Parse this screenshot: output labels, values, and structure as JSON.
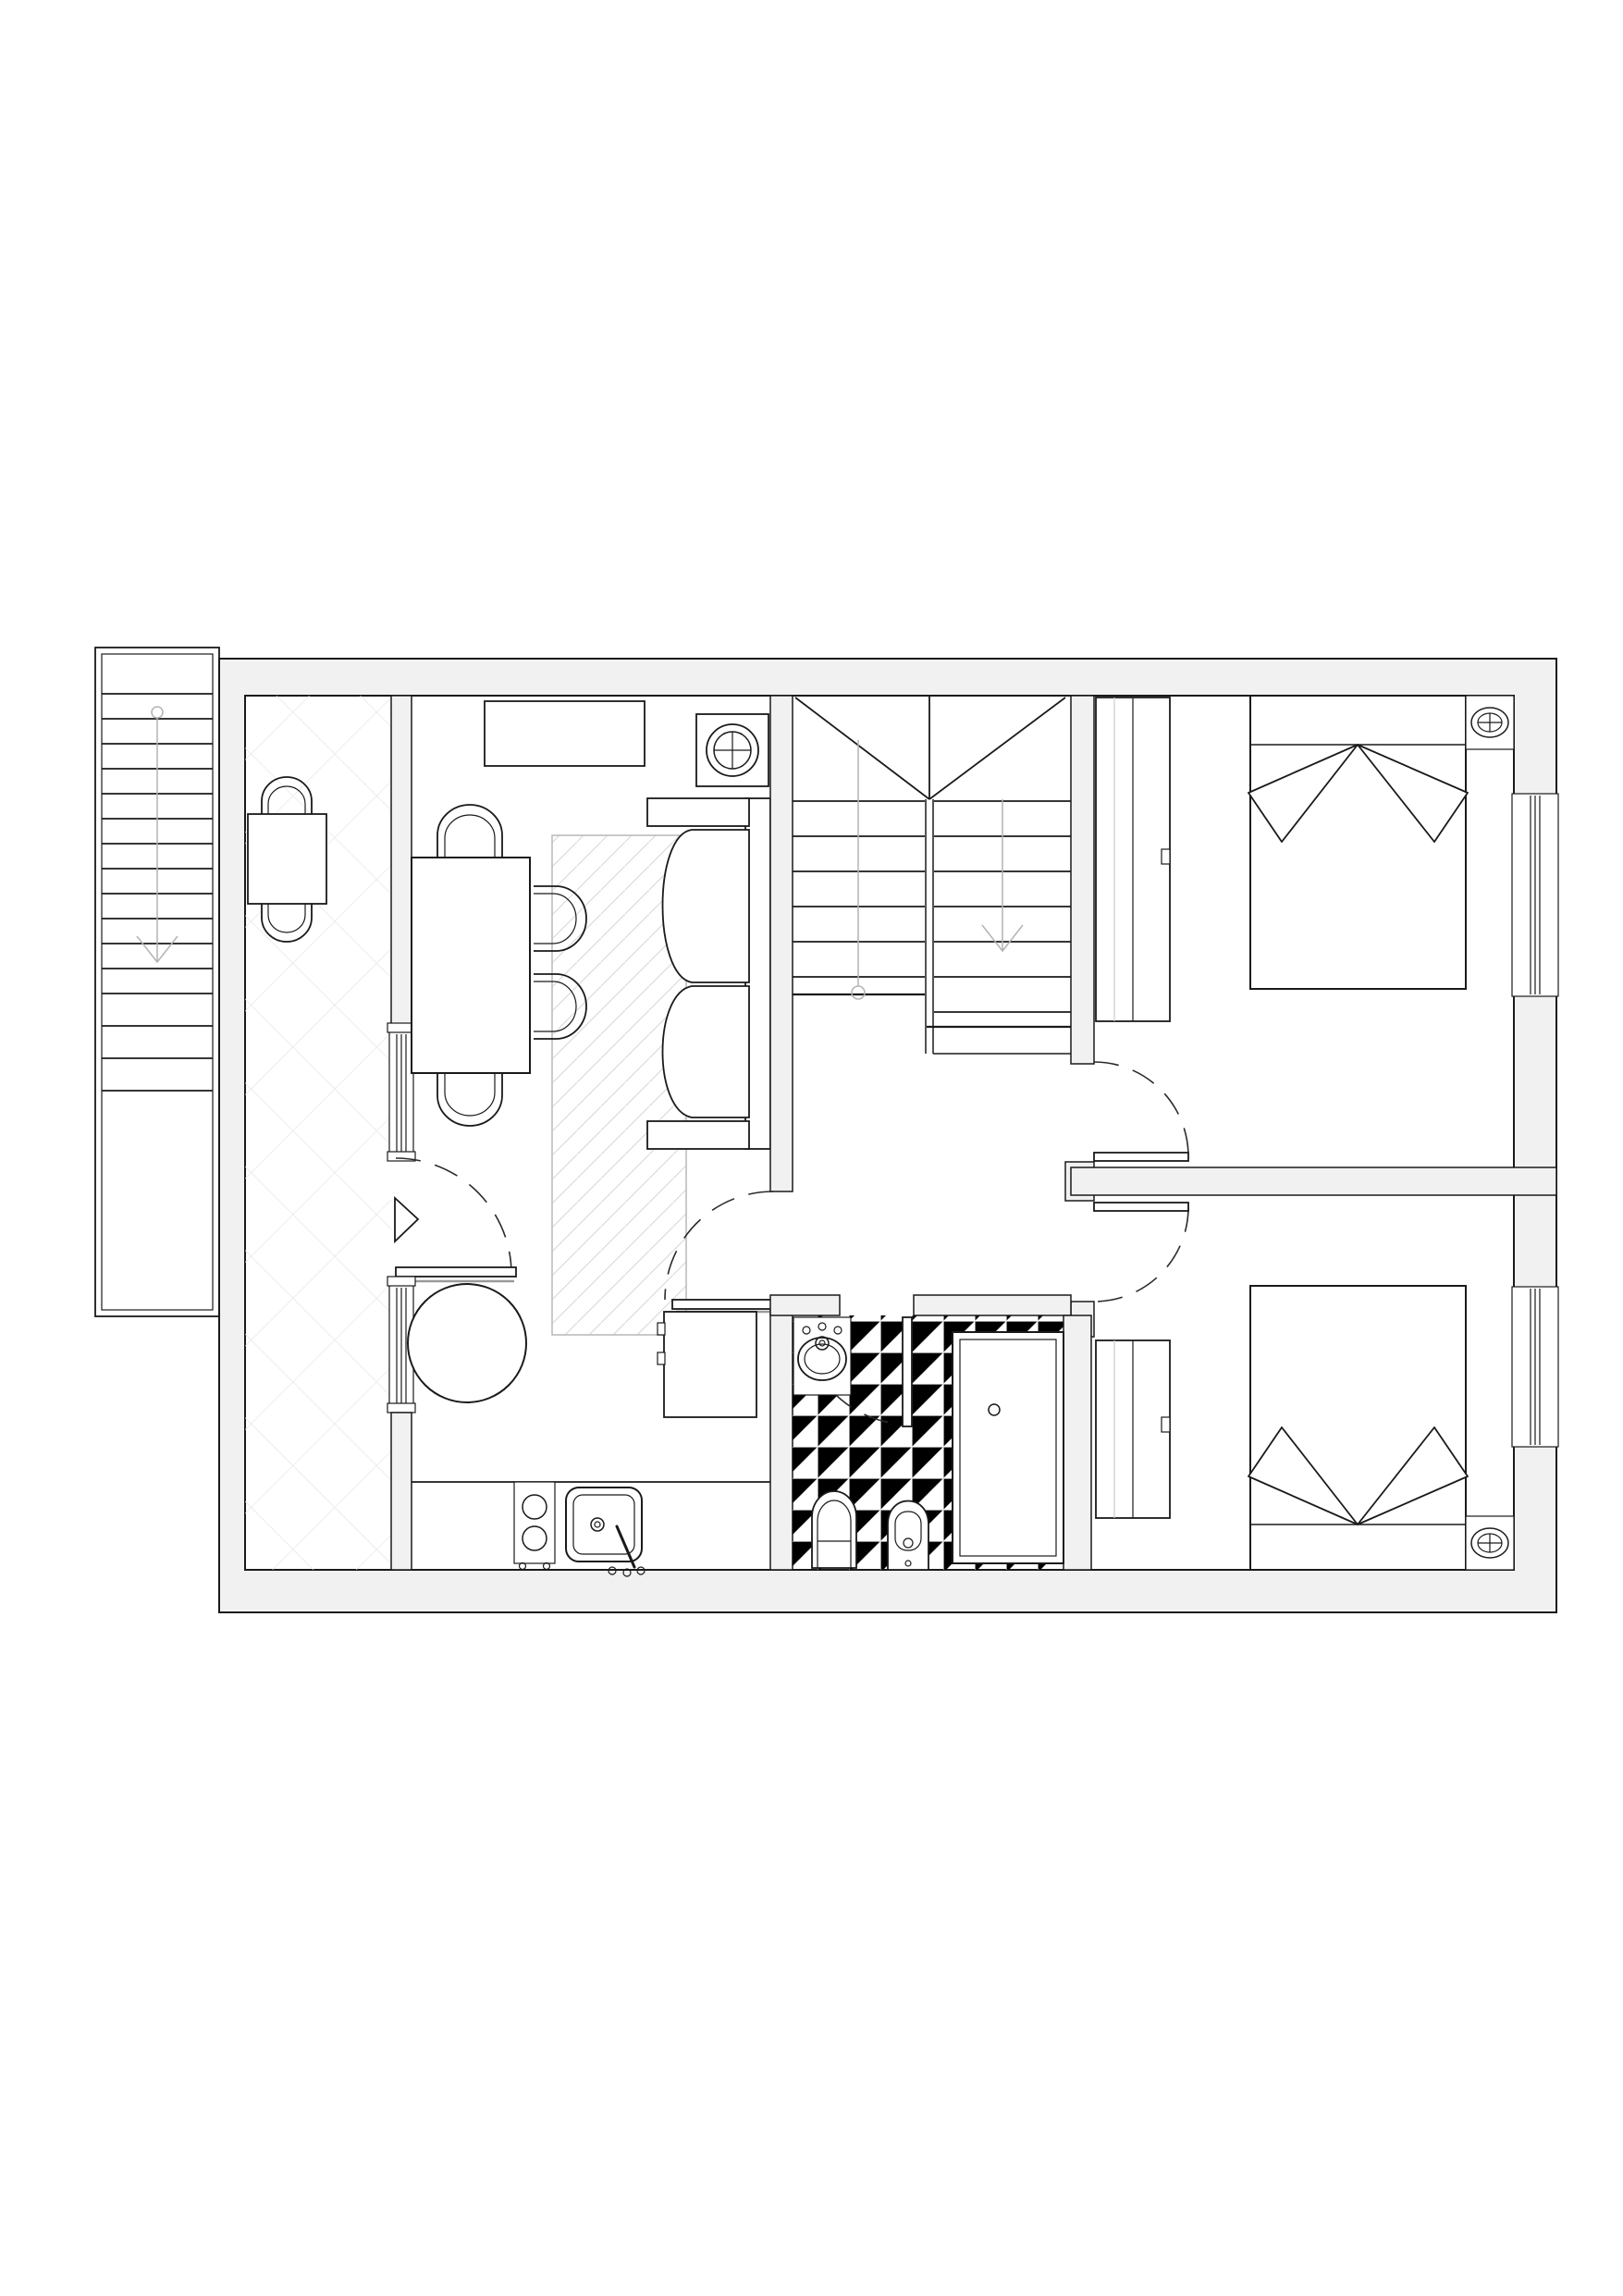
{
  "meta": {
    "description": "Architectural apartment floor plan, black line drawing on white with light gray walls"
  },
  "palette": {
    "background": "#ffffff",
    "wall_fill": "#f1f1f1",
    "line": "#1a1a1a",
    "guide": "#b3b3b3",
    "door_arc": "#2b2b2b",
    "hatch": "#e4e4e4",
    "rug_hatch": "#dcdcdc",
    "tile": "#ebebeb",
    "shadow": "#9a9a9a"
  },
  "areas": [
    "exterior-staircase",
    "terrace",
    "living-room",
    "kitchen",
    "hallway",
    "interior-staircase",
    "bathroom",
    "bedroom-top",
    "bedroom-bottom"
  ],
  "symbols": {
    "stairs": {
      "flights": 3,
      "direction_arrows": "down"
    },
    "doors": [
      "entrance-door",
      "living-room-door",
      "bathroom-door",
      "bedroom-top-door",
      "bedroom-bottom-door"
    ],
    "windows": [
      "terrace-window-upper",
      "terrace-window-lower",
      "bedroom-top-window",
      "bedroom-bottom-window"
    ],
    "furniture": [
      "terrace-table",
      "terrace-chair",
      "terrace-chair",
      "sideboard",
      "ceiling-light",
      "dining-table",
      "dining-chair",
      "dining-chair",
      "dining-chair",
      "dining-chair",
      "rug",
      "sofa",
      "round-table",
      "refrigerator",
      "cooktop",
      "kitchen-sink",
      "washbasin",
      "toilet",
      "bidet",
      "shower",
      "wardrobe",
      "double-bed",
      "ceiling-light",
      "wardrobe",
      "double-bed",
      "ceiling-light"
    ],
    "entrance_marker": "triangle-arrow"
  }
}
